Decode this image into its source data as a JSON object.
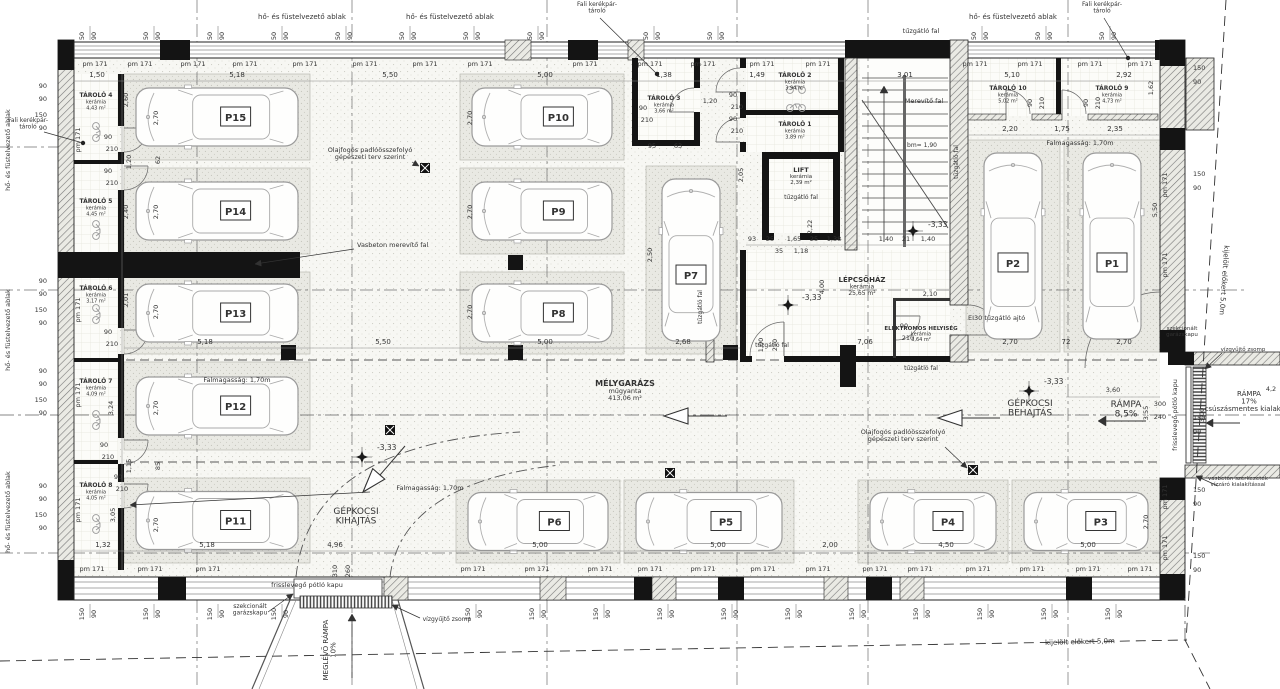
{
  "palette": {
    "ink": "#333333",
    "wall": "#141414",
    "line": "#555555",
    "floor": "#f7f7f3",
    "stall": "#e9e9e3",
    "car": "#9a9a9a",
    "tile": "#fcfcf9"
  },
  "rooms": {
    "main": {
      "name": "MÉLYGARÁZS",
      "finish": "műgyanta",
      "area": "413,06 m²",
      "x": 625,
      "y": 386
    },
    "staircase": {
      "name": "LÉPCSŐHÁZ",
      "finish": "kerámia",
      "area": "25,65 m²",
      "x": 862,
      "y": 282
    },
    "lift": {
      "name": "LIFT",
      "finish": "kerámia",
      "area": "2,39 m²",
      "x": 801,
      "y": 172
    },
    "electrical": {
      "name": "ELEKTROMOS HELYISÉG",
      "finish": "kerámia",
      "area": "3,64 m²",
      "x": 921,
      "y": 330
    }
  },
  "storages": [
    {
      "name": "TÁROLÓ 4",
      "finish": "kerámia",
      "area": "4,43 m²",
      "x": 96,
      "y": 97
    },
    {
      "name": "TÁROLÓ 5",
      "finish": "kerámia",
      "area": "4,45 m²",
      "x": 96,
      "y": 203
    },
    {
      "name": "TÁROLÓ 6",
      "finish": "kerámia",
      "area": "3,17 m²",
      "x": 96,
      "y": 290
    },
    {
      "name": "TÁROLÓ 7",
      "finish": "kerámia",
      "area": "4,09 m²",
      "x": 96,
      "y": 383
    },
    {
      "name": "TÁROLÓ 8",
      "finish": "kerámia",
      "area": "4,05 m²",
      "x": 96,
      "y": 487
    },
    {
      "name": "TÁROLÓ 3",
      "finish": "kerámia",
      "area": "3,66 m²",
      "x": 664,
      "y": 100
    },
    {
      "name": "TÁROLÓ 2",
      "finish": "kerámia",
      "area": "3,94 m²",
      "x": 795,
      "y": 77
    },
    {
      "name": "TÁROLÓ 1",
      "finish": "kerámia",
      "area": "3,89 m²",
      "x": 795,
      "y": 126
    },
    {
      "name": "TÁROLÓ 10",
      "finish": "kerámia",
      "area": "5,02 m²",
      "x": 1008,
      "y": 90
    },
    {
      "name": "TÁROLÓ 9",
      "finish": "kerámia",
      "area": "4,73 m²",
      "x": 1112,
      "y": 90
    }
  ],
  "parking": [
    {
      "id": "P15",
      "x": 124,
      "y": 74,
      "w": 186,
      "h": 86,
      "dir": "h"
    },
    {
      "id": "P14",
      "x": 124,
      "y": 168,
      "w": 186,
      "h": 86,
      "dir": "h"
    },
    {
      "id": "P13",
      "x": 124,
      "y": 272,
      "w": 186,
      "h": 82,
      "dir": "h"
    },
    {
      "id": "P12",
      "x": 124,
      "y": 362,
      "w": 186,
      "h": 88,
      "dir": "h"
    },
    {
      "id": "P11",
      "x": 124,
      "y": 478,
      "w": 186,
      "h": 85,
      "dir": "h"
    },
    {
      "id": "P10",
      "x": 460,
      "y": 74,
      "w": 164,
      "h": 86,
      "dir": "h"
    },
    {
      "id": "P9",
      "x": 460,
      "y": 168,
      "w": 164,
      "h": 86,
      "dir": "h"
    },
    {
      "id": "P8",
      "x": 460,
      "y": 272,
      "w": 164,
      "h": 82,
      "dir": "h"
    },
    {
      "id": "P7",
      "x": 646,
      "y": 166,
      "w": 90,
      "h": 188,
      "dir": "v"
    },
    {
      "id": "P2",
      "x": 966,
      "y": 140,
      "w": 94,
      "h": 212,
      "dir": "v"
    },
    {
      "id": "P1",
      "x": 1064,
      "y": 140,
      "w": 96,
      "h": 212,
      "dir": "v"
    },
    {
      "id": "P6",
      "x": 456,
      "y": 480,
      "w": 164,
      "h": 83,
      "dir": "h"
    },
    {
      "id": "P5",
      "x": 624,
      "y": 480,
      "w": 170,
      "h": 83,
      "dir": "h"
    },
    {
      "id": "P4",
      "x": 858,
      "y": 480,
      "w": 150,
      "h": 83,
      "dir": "h"
    },
    {
      "id": "P3",
      "x": 1012,
      "y": 480,
      "w": 148,
      "h": 83,
      "dir": "h"
    }
  ],
  "dims": {
    "top": [
      [
        "1,50",
        97
      ],
      [
        "5,18",
        237
      ],
      [
        "5,50",
        390
      ],
      [
        "5,00",
        545
      ],
      [
        "1,38",
        664
      ],
      [
        "1,49",
        757
      ],
      [
        "3,01",
        905
      ],
      [
        "5,10",
        1012
      ],
      [
        "2,92",
        1124
      ]
    ],
    "row2": [
      [
        "2,20",
        1010
      ],
      [
        "1,75",
        1062
      ],
      [
        "2,35",
        1115
      ]
    ],
    "mid": [
      [
        "5,18",
        205
      ],
      [
        "5,50",
        383
      ],
      [
        "5,00",
        545
      ],
      [
        "2,68",
        683
      ],
      [
        "7,06",
        865
      ],
      [
        "2,70",
        1010
      ],
      [
        "72",
        1066
      ],
      [
        "2,70",
        1124
      ]
    ],
    "bottom": [
      [
        "1,32",
        103
      ],
      [
        "5,18",
        207
      ],
      [
        "4,96",
        335
      ],
      [
        "5,00",
        540
      ],
      [
        "5,00",
        718
      ],
      [
        "2,00",
        830
      ],
      [
        "4,50",
        946
      ],
      [
        "5,00",
        1088
      ]
    ],
    "stair": [
      [
        "93",
        752
      ],
      [
        "25",
        770
      ],
      [
        "1,65",
        794
      ],
      [
        "25",
        814
      ],
      [
        "1,38",
        834
      ],
      [
        "1,40",
        886
      ],
      [
        "21",
        906
      ],
      [
        "1,40",
        928
      ]
    ],
    "misc": [
      [
        "35",
        779,
        253
      ],
      [
        "1,18",
        801,
        253
      ],
      [
        "2,10",
        930,
        296
      ],
      [
        "1,20",
        710,
        103
      ],
      [
        "95",
        652,
        148
      ],
      [
        "63",
        678,
        148
      ],
      [
        "3,60",
        1113,
        392
      ],
      [
        "300",
        1160,
        406
      ],
      [
        "240",
        1160,
        419
      ],
      [
        "4,2",
        1271,
        391
      ]
    ],
    "rot": [
      [
        "2,60",
        128,
        100
      ],
      [
        "2,70",
        158,
        118
      ],
      [
        "2,40",
        128,
        212
      ],
      [
        "2,70",
        158,
        212
      ],
      [
        "2,70",
        158,
        312
      ],
      [
        "2,01",
        128,
        300
      ],
      [
        "2,70",
        158,
        408
      ],
      [
        "3,24",
        113,
        408
      ],
      [
        "2,70",
        158,
        525
      ],
      [
        "3,05",
        115,
        515
      ],
      [
        "1,15",
        131,
        466
      ],
      [
        "85",
        160,
        466
      ],
      [
        "62",
        160,
        160
      ],
      [
        "1,20",
        131,
        162
      ],
      [
        "2,70",
        472,
        118
      ],
      [
        "2,70",
        472,
        212
      ],
      [
        "2,70",
        472,
        312
      ],
      [
        "2,50",
        652,
        255
      ],
      [
        "2,05",
        743,
        175
      ],
      [
        "2,22",
        812,
        227
      ],
      [
        "4,00",
        824,
        287
      ],
      [
        "1,00",
        763,
        345
      ],
      [
        "210",
        777,
        345
      ],
      [
        "1,62",
        1153,
        88
      ],
      [
        "5,50",
        1157,
        210
      ],
      [
        "3,55",
        1148,
        413
      ],
      [
        "3,00",
        1204,
        415
      ],
      [
        "310",
        337,
        571
      ],
      [
        "260",
        350,
        571
      ],
      [
        "2,70",
        1148,
        522
      ]
    ],
    "door_pair": [
      "90",
      "210"
    ],
    "door_positions": [
      [
        108,
        139
      ],
      [
        108,
        173
      ],
      [
        108,
        334
      ],
      [
        104,
        447
      ],
      [
        118,
        479
      ],
      [
        643,
        110
      ],
      [
        733,
        97
      ],
      [
        733,
        121
      ],
      [
        904,
        328
      ]
    ],
    "door_rot": [
      [
        "90",
        1032,
        103
      ],
      [
        "210",
        1044,
        103
      ],
      [
        "90",
        1088,
        103
      ],
      [
        "210",
        1100,
        103
      ]
    ]
  },
  "ticks": {
    "pm": "pm 171",
    "top": {
      "vals": [
        "50",
        "90"
      ],
      "y": 36,
      "xs": [
        84,
        148,
        212,
        276,
        340,
        404,
        468,
        532,
        648,
        712,
        976,
        1040,
        1104
      ]
    },
    "bottom": {
      "vals": [
        "150",
        "90"
      ],
      "y": 614,
      "xs": [
        84,
        148,
        212,
        276,
        470,
        534,
        598,
        662,
        726,
        790,
        854,
        918,
        982,
        1046,
        1110
      ]
    },
    "left": {
      "vals": [
        "90",
        "90",
        "150",
        "90"
      ],
      "x": 47,
      "groups": [
        [
          88,
          101,
          117,
          130
        ],
        [
          283,
          296,
          312,
          325
        ],
        [
          373,
          386,
          402,
          415
        ],
        [
          488,
          501,
          517,
          530
        ]
      ]
    },
    "right": {
      "vals": [
        "150",
        "90"
      ],
      "x": 1193,
      "groups": [
        [
          70,
          84
        ],
        [
          176,
          190
        ],
        [
          420,
          434
        ],
        [
          492,
          506
        ],
        [
          558,
          572
        ]
      ]
    },
    "pm_top": {
      "y": 66,
      "xs": [
        95,
        140,
        193,
        245,
        305,
        365,
        425,
        480,
        585,
        650,
        703,
        762,
        818,
        975,
        1030,
        1090,
        1140
      ]
    },
    "pm_bottom": {
      "y": 571,
      "xs": [
        92,
        150,
        208,
        473,
        537,
        600,
        650,
        703,
        763,
        818,
        875,
        920,
        978,
        1032,
        1088,
        1140
      ]
    },
    "pm_left": {
      "x": 80,
      "ys": [
        140,
        310,
        395,
        510
      ]
    },
    "pm_right": {
      "x": 1167,
      "ys": [
        185,
        265,
        497,
        548
      ]
    }
  },
  "annotations": [
    {
      "t": "hő- és füstelvezető ablak",
      "x": 302,
      "y": 19,
      "s": 7
    },
    {
      "t": "hő- és füstelvezető ablak",
      "x": 450,
      "y": 19,
      "s": 7
    },
    {
      "t": "Fali kerékpár-\ntároló",
      "x": 597,
      "y": 6,
      "s": 6,
      "leader": [
        600,
        18,
        657,
        74
      ],
      "dot": true
    },
    {
      "t": "tűzgátló fal",
      "x": 921,
      "y": 33,
      "s": 6.5
    },
    {
      "t": "hő- és füstelvezető ablak",
      "x": 1013,
      "y": 19,
      "s": 7
    },
    {
      "t": "Fali kerékpár-\ntároló",
      "x": 1102,
      "y": 6,
      "s": 6,
      "leader": [
        1104,
        18,
        1128,
        58
      ],
      "dot": true
    },
    {
      "t": "hő- és füstelvezető ablak",
      "x": 10,
      "y": 150,
      "s": 6.5,
      "rot": -90
    },
    {
      "t": "hő- és füstelvezető ablak",
      "x": 10,
      "y": 330,
      "s": 6.5,
      "rot": -90
    },
    {
      "t": "hő- és füstelvezető ablak",
      "x": 10,
      "y": 512,
      "s": 6.5,
      "rot": -90
    },
    {
      "t": "Fali kerékpár-\ntároló",
      "x": 28,
      "y": 122,
      "s": 6,
      "leader": [
        44,
        132,
        83,
        143
      ],
      "dot": true
    },
    {
      "t": "Olajfogós padlóösszefolyó\ngépészeti terv szerint",
      "x": 370,
      "y": 152,
      "s": 6.5,
      "leader": [
        412,
        162,
        419,
        166
      ]
    },
    {
      "t": "Olajfogós padlóösszefolyó\ngépészeti terv szerint",
      "x": 903,
      "y": 434,
      "s": 6.5,
      "leader": [
        945,
        447,
        967,
        468
      ]
    },
    {
      "t": "Vasbeton merevítő fal",
      "x": 357,
      "y": 247,
      "s": 6.5,
      "a": "start",
      "leader": [
        354,
        249,
        255,
        264
      ]
    },
    {
      "t": "Falmagasság: 1,70m",
      "x": 237,
      "y": 382,
      "s": 6.5
    },
    {
      "t": "Falmagasság: 1,70m",
      "x": 430,
      "y": 490,
      "s": 6.5,
      "leader": [
        370,
        492,
        130,
        505
      ]
    },
    {
      "t": "Falmagasság: 1,70m",
      "x": 1080,
      "y": 145,
      "s": 6.5
    },
    {
      "t": "Merevítő fal",
      "x": 924,
      "y": 103,
      "s": 6.5
    },
    {
      "t": "tűzgátló fal",
      "x": 801,
      "y": 199,
      "s": 6
    },
    {
      "t": "tűzgátló fal",
      "x": 702,
      "y": 307,
      "s": 6,
      "rot": -90
    },
    {
      "t": "tűzgátló fal",
      "x": 772,
      "y": 347,
      "s": 6
    },
    {
      "t": "tűzgátló fal",
      "x": 921,
      "y": 370,
      "s": 6
    },
    {
      "t": "tűzgátló fal",
      "x": 958,
      "y": 162,
      "s": 6,
      "rot": -90
    },
    {
      "t": "EI30 tűzgátló ajtó",
      "x": 968,
      "y": 320,
      "s": 6.5,
      "a": "start"
    },
    {
      "t": "bm= 1,90",
      "x": 922,
      "y": 147,
      "s": 6
    },
    {
      "t": "GÉPKOCSI\nKIHAJTÁS",
      "x": 356,
      "y": 514,
      "s": 9
    },
    {
      "t": "GÉPKOCSI\nBEHAJTÁS",
      "x": 1030,
      "y": 406,
      "s": 9
    },
    {
      "t": "RÁMPA\n8,5%",
      "x": 1126,
      "y": 407,
      "s": 9
    },
    {
      "t": "RÁMPA\n17%\ncsúszásmentes kialakítás",
      "x": 1249,
      "y": 396,
      "s": 7
    },
    {
      "t": "szekcionált\ngarázskapu",
      "x": 250,
      "y": 608,
      "s": 6,
      "leader": [
        268,
        612,
        293,
        594
      ]
    },
    {
      "t": "vízgyűjtő zsomp",
      "x": 447,
      "y": 621,
      "s": 6,
      "leader": [
        420,
        618,
        392,
        605
      ]
    },
    {
      "t": "frisslevegő pótló kapu",
      "x": 307,
      "y": 587,
      "s": 6.5
    },
    {
      "t": "frisslevegő pótló kapu",
      "x": 1177,
      "y": 415,
      "s": 6.5,
      "rot": -90
    },
    {
      "t": "szekcionált\ngarázskapu",
      "x": 1182,
      "y": 330,
      "s": 5.5
    },
    {
      "t": "vízgyűjtő zsomp",
      "x": 1243,
      "y": 351,
      "s": 5.5,
      "leader": [
        1222,
        353,
        1205,
        369
      ]
    },
    {
      "t": "vasbeton szerkezetek\nvízzáró kialakítással",
      "x": 1238,
      "y": 480,
      "s": 5.5,
      "leader": [
        1218,
        486,
        1196,
        476
      ]
    },
    {
      "t": "kijelölt előkert 5,0m",
      "x": 1080,
      "y": 644,
      "s": 7,
      "rot": -1.5
    },
    {
      "t": "kijelölt előkert 5,0m",
      "x": 1222,
      "y": 280,
      "s": 7,
      "rot": 94
    },
    {
      "t": "MEGLÉVŐ RÁMPA\n10%",
      "x": 328,
      "y": 650,
      "s": 7,
      "rot": -90
    }
  ],
  "elevation": {
    "label": "-3,33",
    "points": [
      {
        "x": 362,
        "y": 457,
        "tx": 377,
        "ty": 450
      },
      {
        "x": 788,
        "y": 305,
        "tx": 802,
        "ty": 300
      },
      {
        "x": 913,
        "y": 231,
        "tx": 928,
        "ty": 227
      },
      {
        "x": 1029,
        "y": 391,
        "tx": 1044,
        "ty": 384
      }
    ]
  },
  "drains": [
    [
      425,
      168
    ],
    [
      390,
      430
    ],
    [
      670,
      473
    ],
    [
      973,
      470
    ]
  ]
}
